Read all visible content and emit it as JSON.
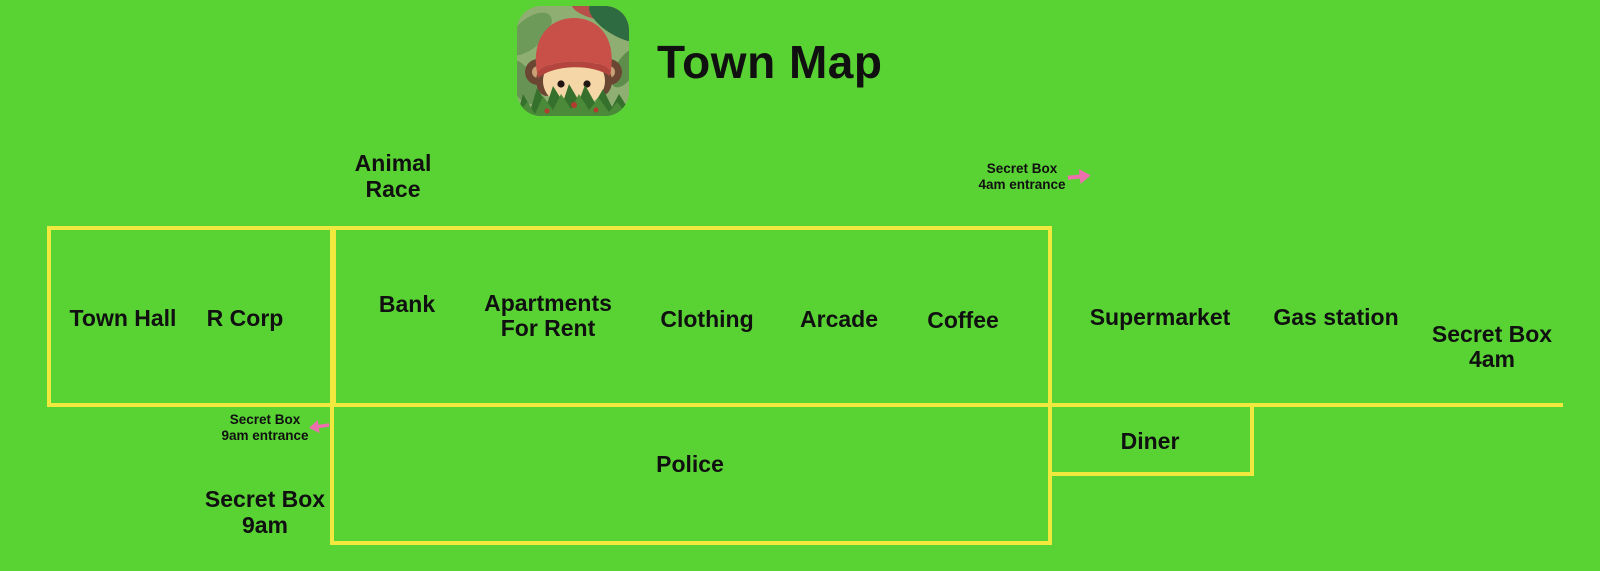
{
  "colors": {
    "background": "#59d334",
    "line": "#f2e93e",
    "arrow": "#ee6fae",
    "text": "#101010"
  },
  "header": {
    "title": "Town Map",
    "icon": "monkey-in-bushes"
  },
  "labels": {
    "animal_race": {
      "lines": [
        "Animal",
        "Race"
      ]
    },
    "secret_box_4am_entrance": {
      "lines": [
        "Secret Box",
        "4am entrance"
      ],
      "arrow": "right"
    },
    "town_hall": {
      "text": "Town Hall"
    },
    "r_corp": {
      "text": "R Corp"
    },
    "bank": {
      "text": "Bank"
    },
    "apartments": {
      "lines": [
        "Apartments",
        "For Rent"
      ]
    },
    "clothing": {
      "text": "Clothing"
    },
    "arcade": {
      "text": "Arcade"
    },
    "coffee": {
      "text": "Coffee"
    },
    "supermarket": {
      "text": "Supermarket"
    },
    "gas_station": {
      "text": "Gas station"
    },
    "secret_box_4am": {
      "lines": [
        "Secret Box",
        "4am"
      ]
    },
    "secret_box_9am_entrance": {
      "lines": [
        "Secret Box",
        "9am entrance"
      ],
      "arrow": "left"
    },
    "secret_box_9am": {
      "lines": [
        "Secret Box",
        "9am"
      ]
    },
    "police": {
      "text": "Police"
    },
    "diner": {
      "text": "Diner"
    }
  }
}
